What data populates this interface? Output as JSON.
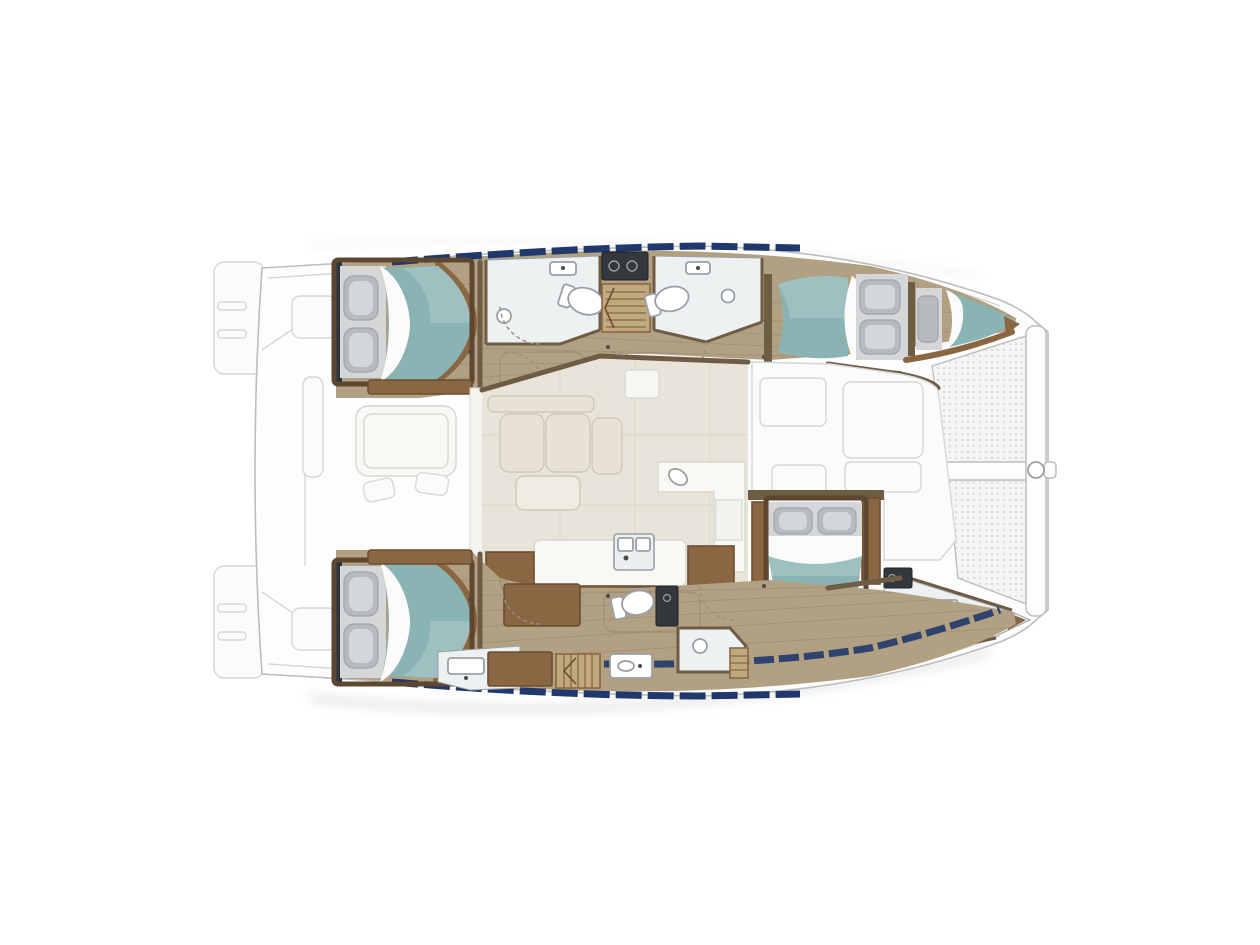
{
  "page": {
    "title": "Catamaran yacht interior floor plan (top view)",
    "view": "top-down deck plan, bow pointing right, stern at left"
  },
  "colors": {
    "background": "#ffffff",
    "hull_fill": "#fdfdfd",
    "hull_stroke": "#bdbdbd",
    "ghost_stroke": "#d7d7d7",
    "ghost_fill": "#fbfbfb",
    "cockpit_pad": "#ecdfc6",
    "wood_floor": "#b2a083",
    "wood_light": "#c0a87f",
    "plank_line": "#8f7d64",
    "wall_brown": "#6f5c45",
    "furniture_wood": "#8a6742",
    "furniture_wood_dark": "#6b4e31",
    "bed_frame": "#5d4730",
    "dark_edge": "#2c3440",
    "bed_teal": "#8ab3b4",
    "sheet_white": "#fbfbfb",
    "pillow_gray": "#b7bbbe",
    "pillow_shadow": "#a0a5a9",
    "pillow_highlight": "#dfe2e4",
    "headboard_gray": "#d4d6d8",
    "bathroom_floor": "#eef1f2",
    "fixture_white": "#ffffff",
    "fixture_stroke": "#9aa0a5",
    "salon_floor": "#e8e4d9",
    "salon_line": "#d9d4c7",
    "sofa_fill": "#e7e2d5",
    "sofa_stroke": "#cfc9ba",
    "counter_white": "#f8f8f5",
    "counter_stroke": "#d8d8d0",
    "window_navy": "#20386b",
    "door_arc": "#998f82",
    "sunpad_tan": "#dcc9a4",
    "tramp_fill": "#f5f5f5",
    "tramp_dot": "#d8d8d8",
    "dark_appliance": "#34383c",
    "shadow_gray": "#dcdcdc"
  },
  "plan": {
    "vessel_type": "catamaran",
    "hulls": [
      {
        "id": "port-hull",
        "position": "top",
        "spaces": [
          "aft-double-cabin",
          "aft-bathroom",
          "companionway-stairs",
          "forward-bathroom",
          "corridor",
          "forward-double-cabin",
          "bow-berth"
        ]
      },
      {
        "id": "starboard-hull",
        "position": "bottom",
        "spaces": [
          "aft-double-cabin",
          "aft-head",
          "desk",
          "corridor",
          "day-toilet",
          "shower-room",
          "companionway-stairs",
          "owner-double-cabin",
          "owner-bathroom"
        ]
      }
    ],
    "bridgedeck": [
      "salon-lounge",
      "l-shaped-sofa",
      "coffee-table",
      "galley-l-counter",
      "galley-island-with-sink",
      "shelf-units",
      "forward-lounge"
    ],
    "exterior": [
      "aft-cockpit",
      "cockpit-table",
      "cockpit-stools",
      "transom-steps",
      "bow-trampoline",
      "forward-crossbeam",
      "hull-window-strips"
    ]
  },
  "fixtures_legend": [
    "toilet",
    "wash-basin",
    "shower-head",
    "cooktop",
    "staircase",
    "door-swing-arc",
    "double-bed",
    "single-berth",
    "pillows",
    "trampoline-mesh"
  ],
  "counts": {
    "double_beds": 4,
    "single_berths": 1,
    "toilets": 4,
    "showers": 4,
    "staircases": 3
  }
}
